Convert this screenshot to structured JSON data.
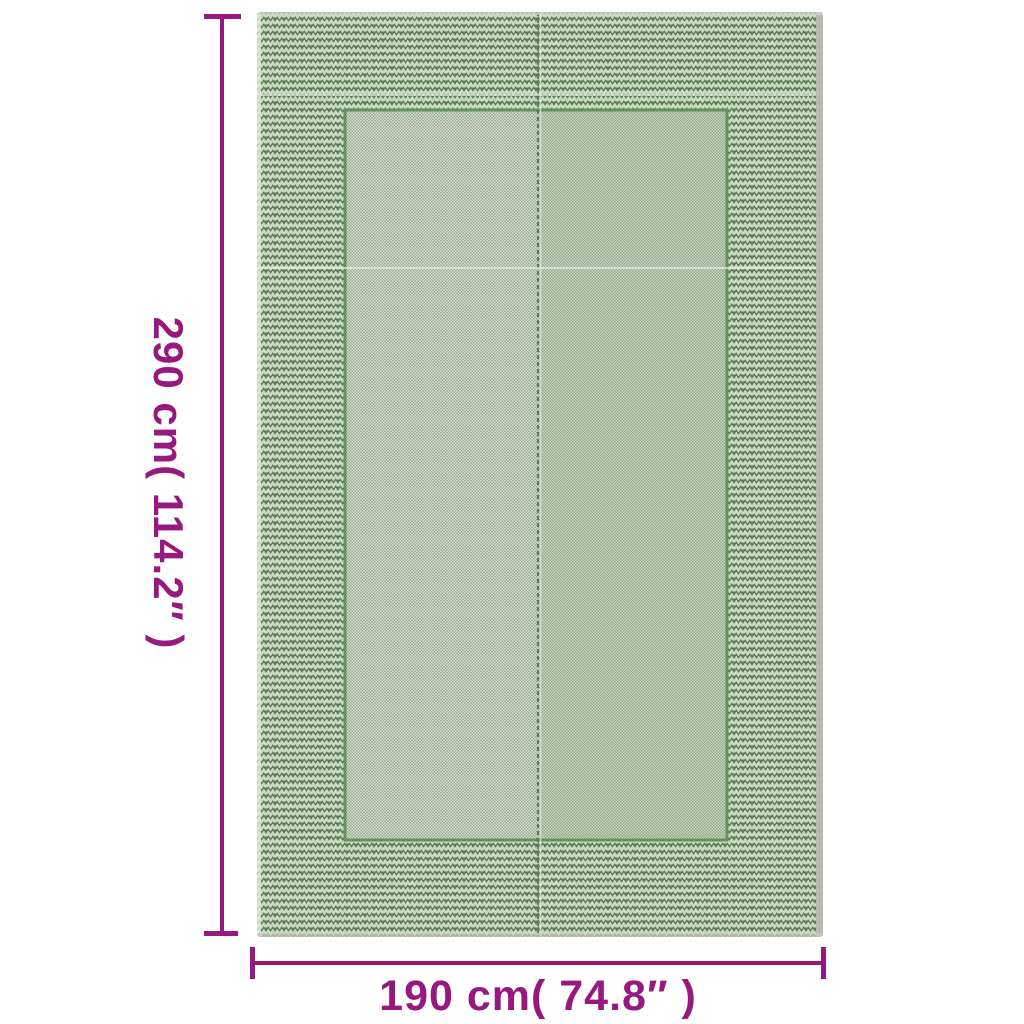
{
  "annotation": {
    "color": "#97187f",
    "height_label": "290 cm( 114.2″ )",
    "width_label": "190 cm( 74.8″ )"
  },
  "rug": {
    "kind": "green woven outdoor rug",
    "border_pattern": "chevron-zigzag",
    "field_pattern": "fine-weave-check",
    "colors": {
      "border_dark_green": "#5a7f54",
      "border_light_zigzag": "#ccdac5",
      "field_light": "#d8e0d2",
      "field_dot_green": "#93ad8d",
      "edge_gray": "#b7bcb3"
    }
  },
  "background_color": "#ffffff"
}
